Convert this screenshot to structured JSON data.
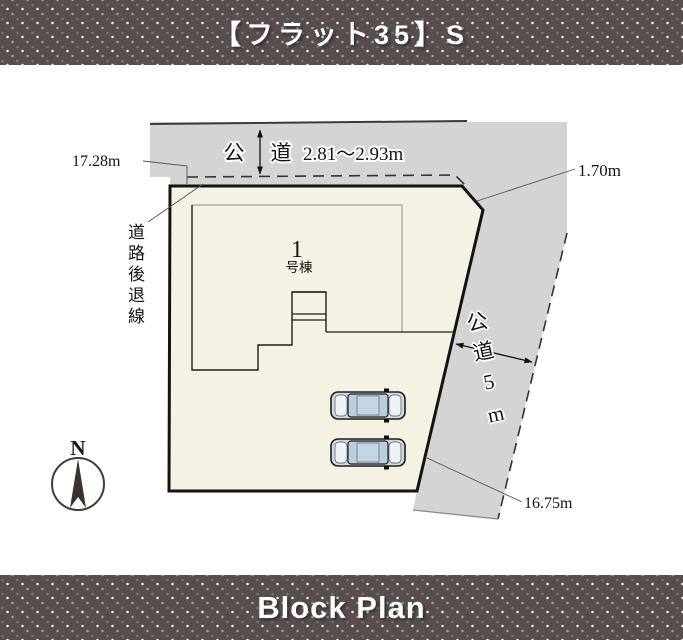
{
  "header": {
    "title": "【フラット35】S"
  },
  "footer": {
    "title": "Block Plan"
  },
  "plan": {
    "top_road": {
      "kanji_left": "公",
      "kanji_right": "道",
      "width_label": "2.81～2.93m"
    },
    "side_road": {
      "label": "公道5m"
    },
    "dims": {
      "left": "17.28m",
      "corner": "1.70m",
      "bottom": "16.75m"
    },
    "setback_label": "道路後退線",
    "building": {
      "number": "1",
      "suffix": "号棟"
    },
    "compass": {
      "north": "N"
    },
    "colors": {
      "banner_bg": "#584f4d",
      "road_gray": "#d5d4d2",
      "parcel_fill": "#f5f2e4",
      "building_label": "#8e4a2c",
      "car_body": "#ccdae6"
    }
  }
}
